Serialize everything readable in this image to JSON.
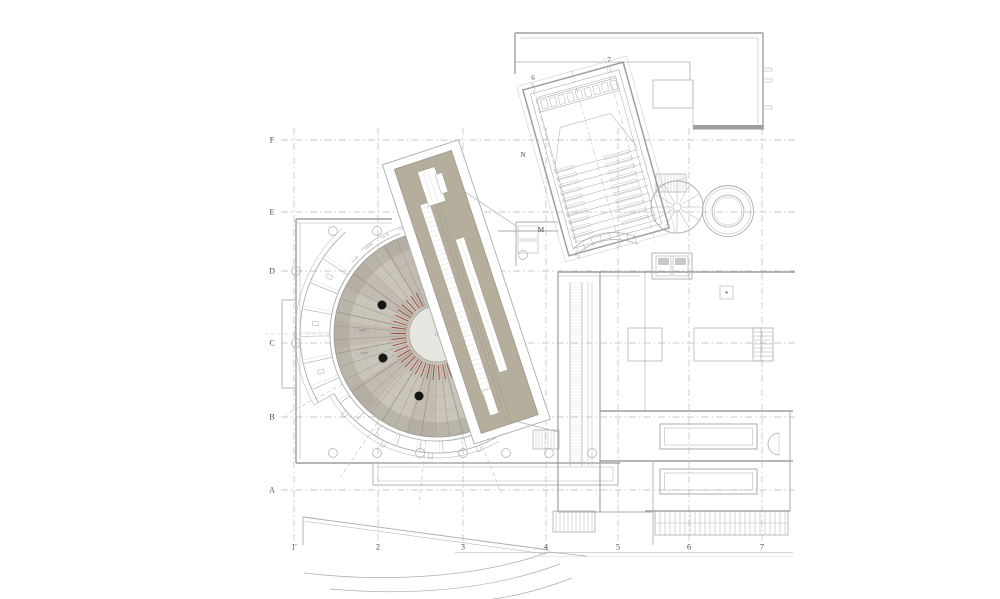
{
  "drawing": {
    "type": "architectural-floor-plan",
    "subject": "theatre auditorium and concert hall level plan"
  },
  "colors": {
    "line": "#a9aeac",
    "wall": "#99a09d",
    "light": "#c6c9c7",
    "dash": "#b6b9b7",
    "tan": "#b6ae9c",
    "tanline": "#9c968a",
    "fan": "#cac5bb",
    "fanDark": "#a39d8f",
    "fanLine": "#9b968c",
    "center": "#e7e5df",
    "red": "#9e4436",
    "dot": "#161616",
    "text": "#4a4a4a"
  },
  "grid": {
    "rows": [
      {
        "label": "F",
        "y": 140
      },
      {
        "label": "E",
        "y": 212
      },
      {
        "label": "D",
        "y": 271
      },
      {
        "label": "C",
        "y": 343
      },
      {
        "label": "B",
        "y": 417
      },
      {
        "label": "A",
        "y": 490
      }
    ],
    "cols": [
      {
        "label": "1'",
        "x": 294
      },
      {
        "label": "2",
        "x": 378
      },
      {
        "label": "3",
        "x": 463
      },
      {
        "label": "4",
        "x": 546
      },
      {
        "label": "5",
        "x": 618
      },
      {
        "label": "6",
        "x": 689
      },
      {
        "label": "7",
        "x": 762
      }
    ]
  },
  "hall_labels": [
    {
      "label": "6",
      "x": 533,
      "y": 80
    },
    {
      "label": "7",
      "x": 609,
      "y": 62
    },
    {
      "label": "N",
      "x": 523,
      "y": 157
    },
    {
      "label": "M",
      "x": 541,
      "y": 232
    }
  ],
  "level_labels": [
    {
      "label": "11.25",
      "x": 362,
      "y": 331
    },
    {
      "label": "11.05",
      "x": 364,
      "y": 354
    }
  ],
  "rim_levels": [
    "+11.25",
    "+11.20",
    "+11.15",
    "+11.05"
  ]
}
